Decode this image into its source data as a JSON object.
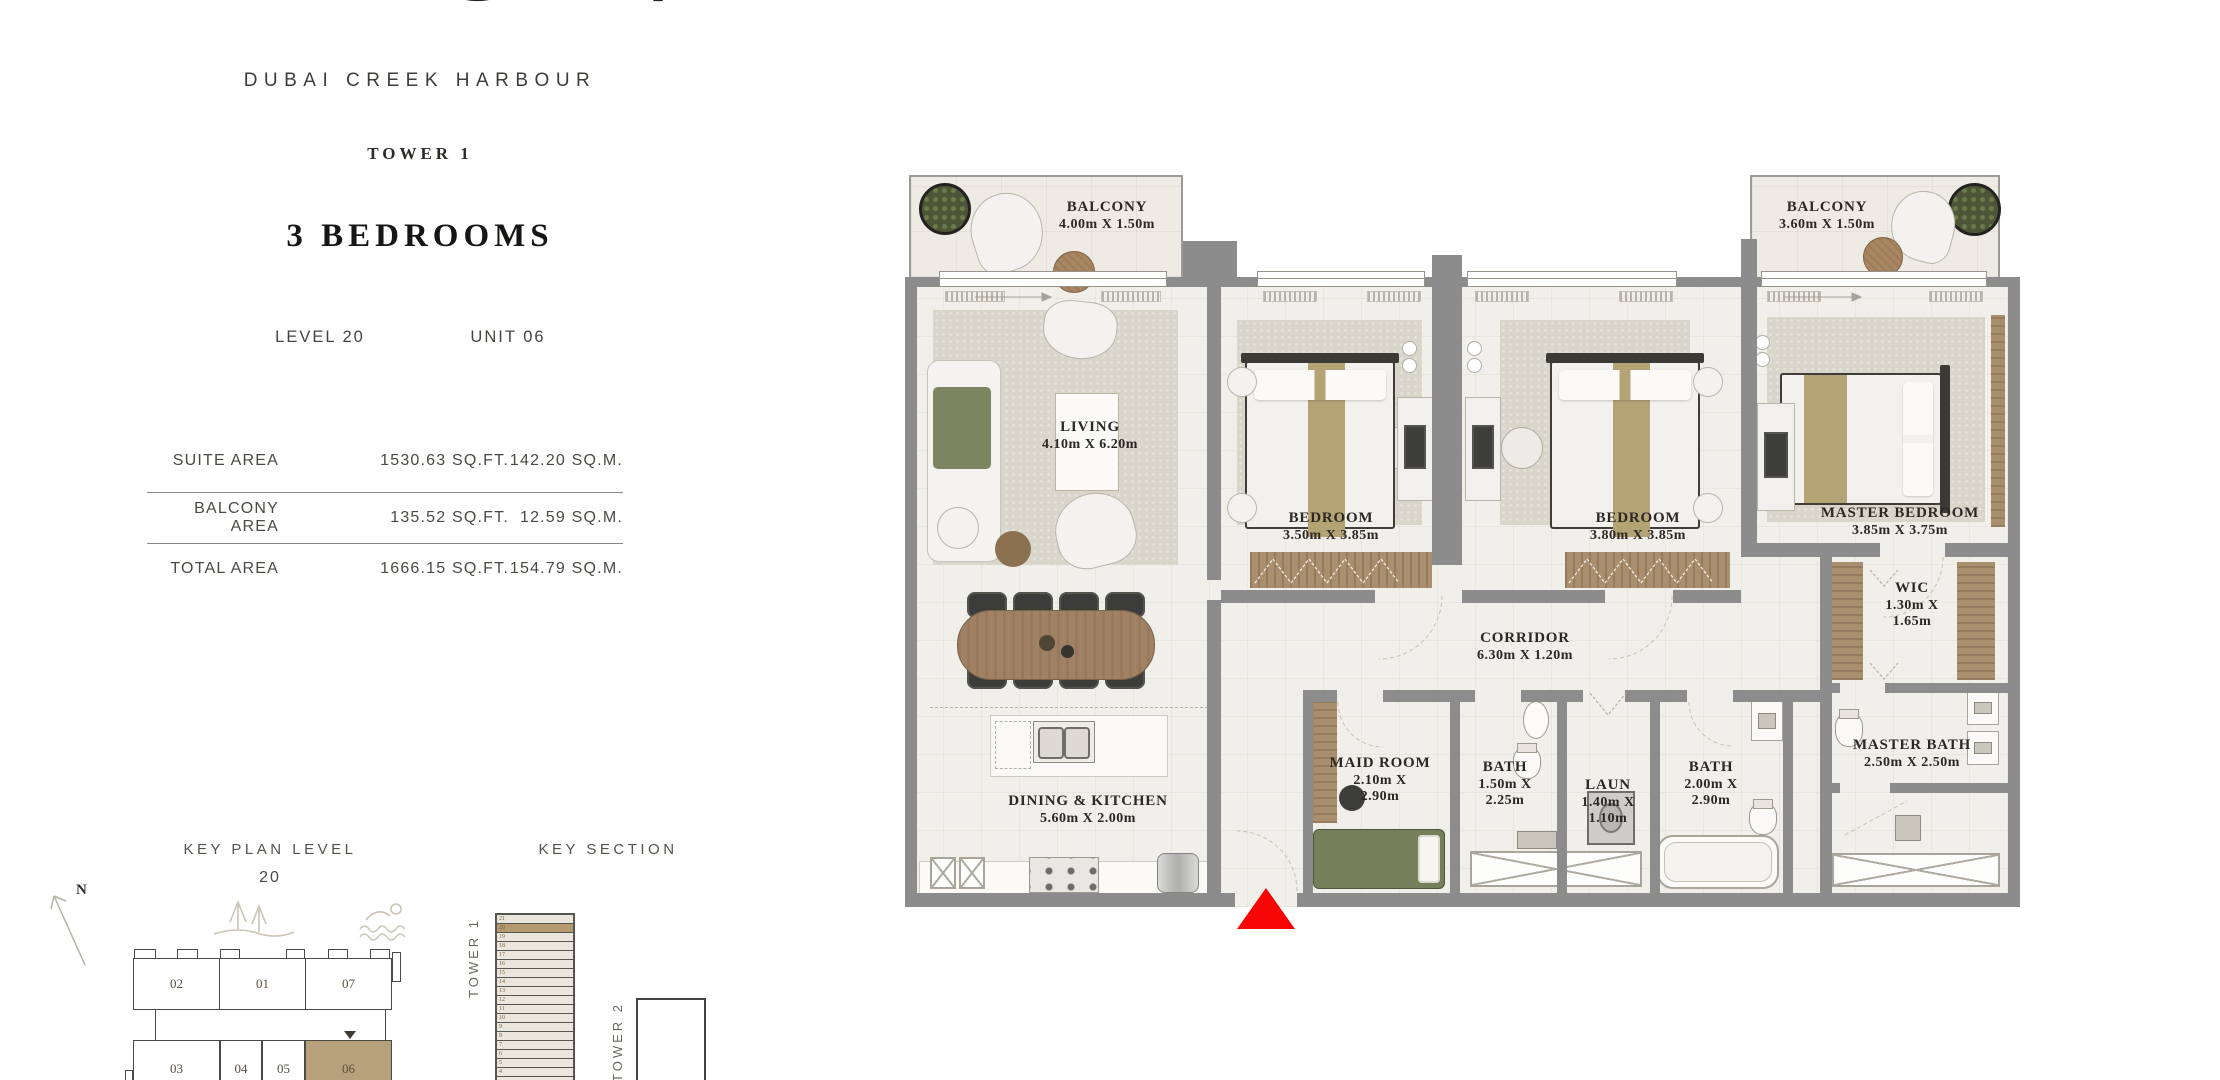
{
  "brand": {
    "logo_text": "AEON",
    "project_name": "DUBAI CREEK HARBOUR",
    "tower_name": "TOWER 1",
    "unit_type": "3 BEDROOMS",
    "level_label": "LEVEL 20",
    "unit_label": "UNIT 06"
  },
  "area_table": {
    "rows": [
      {
        "label": "SUITE AREA",
        "sqft": "1530.63 SQ.FT.",
        "sqm": "142.20 SQ.M."
      },
      {
        "label": "BALCONY AREA",
        "sqft": "135.52 SQ.FT.",
        "sqm": "12.59 SQ.M."
      },
      {
        "label": "TOTAL AREA",
        "sqft": "1666.15 SQ.FT.",
        "sqm": "154.79 SQ.M."
      }
    ]
  },
  "key_plan": {
    "title": "KEY PLAN LEVEL",
    "level_number": "20",
    "north_label": "N",
    "units_top": [
      "02",
      "01",
      "07"
    ],
    "units_bottom": [
      "03",
      "04",
      "05",
      "06"
    ],
    "highlighted_unit": "06"
  },
  "key_section": {
    "title": "KEY SECTION",
    "tower1_label": "TOWER 1",
    "tower2_label": "TOWER 2",
    "floors": [
      "21",
      "20",
      "19",
      "18",
      "17",
      "16",
      "15",
      "14",
      "13",
      "12",
      "11",
      "10",
      "9",
      "8",
      "7",
      "6",
      "5",
      "4"
    ],
    "highlighted_floor": "20"
  },
  "floor_plan": {
    "rooms": [
      {
        "name": "BALCONY",
        "dims": "4.00m X 1.50m"
      },
      {
        "name": "BALCONY",
        "dims": "3.60m X 1.50m"
      },
      {
        "name": "LIVING",
        "dims": "4.10m X 6.20m"
      },
      {
        "name": "BEDROOM",
        "dims": "3.50m X 3.85m"
      },
      {
        "name": "BEDROOM",
        "dims": "3.80m X 3.85m"
      },
      {
        "name": "MASTER BEDROOM",
        "dims": "3.85m X 3.75m"
      },
      {
        "name": "WIC",
        "dims": "1.30m X 1.65m"
      },
      {
        "name": "CORRIDOR",
        "dims": "6.30m X 1.20m"
      },
      {
        "name": "MAID ROOM",
        "dims": "2.10m X 2.90m"
      },
      {
        "name": "BATH",
        "dims": "1.50m X 2.25m"
      },
      {
        "name": "LAUN",
        "dims": "1.40m X 1.10m"
      },
      {
        "name": "BATH",
        "dims": "2.00m X 2.90m"
      },
      {
        "name": "MASTER BATH",
        "dims": "2.50m X 2.50m"
      },
      {
        "name": "DINING & KITCHEN",
        "dims": "5.60m X 2.00m"
      }
    ]
  },
  "colors": {
    "highlight_tan": "#b49a71",
    "wall_gray": "#8c8c8c",
    "wood": "#aa8f6e",
    "maid_bed_green": "#75805a",
    "entrance_red": "#f70404"
  }
}
